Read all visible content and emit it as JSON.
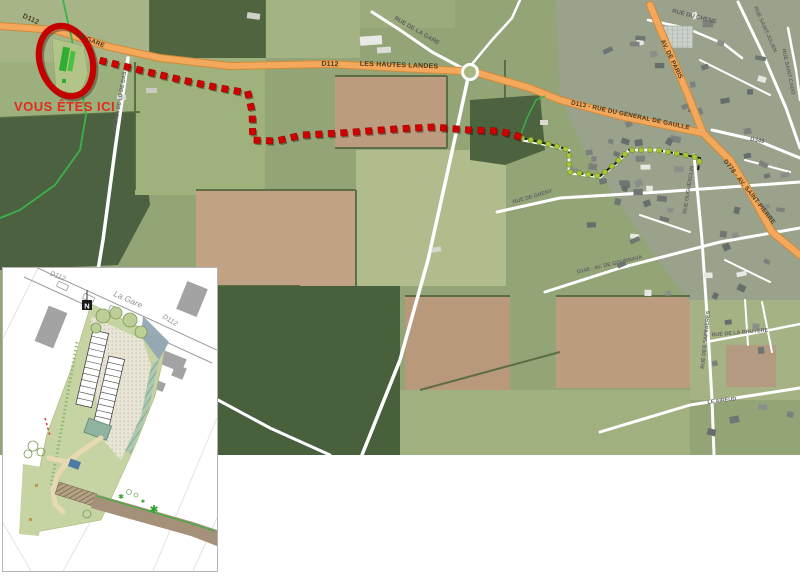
{
  "map": {
    "you_are_here": "VOUS ÊTES ICI",
    "roads": {
      "d112_nw": "D112",
      "la_gare": "LA GARE",
      "d112_c": "D112",
      "les_hautes_landes": "LES HAUTES LANDES",
      "rue_de_la_gare": "RUE DE LA GARE",
      "d113_gaulle": "D113 - RUE DU GENERAL DE GAULLE",
      "av_de_paris": "AV. DE PARIS",
      "rue_du_chene": "RUE DU CHENE",
      "rue_saint_julien": "RUE SAINT-JULIEN",
      "rue_saint_cado": "RUE SAINT-CADO",
      "d349": "D349",
      "d778_saint_pierre": "D778 - AV. SAINT-PIERRE",
      "rue_duguesclin": "RUE DUGUESCLIN",
      "rue_des_sapinieres": "RUE DES SAPINIERES",
      "rue_de_la_bruyere": "RUE DE LA BRUYERE",
      "le_aireud": "LE AIREUD",
      "d145_gournava": "D145 - AV. DE GOURNAVA",
      "rue_de_greny": "RUE DE GRENY",
      "chemin_de_lo_de_bas": "CHEMIN DE LO DE BAS"
    },
    "colors": {
      "route_red": "#d10000",
      "route_green": "#a8c832",
      "road_orange": "#f3a85c",
      "road_orange_edge": "#d08a3a",
      "highlight_red": "#c40000",
      "you_are_here_red": "#e22b1c"
    }
  },
  "inset": {
    "d112_left": "D112",
    "la_gare": "La Gare",
    "d112_right": "D112",
    "north": "N"
  }
}
